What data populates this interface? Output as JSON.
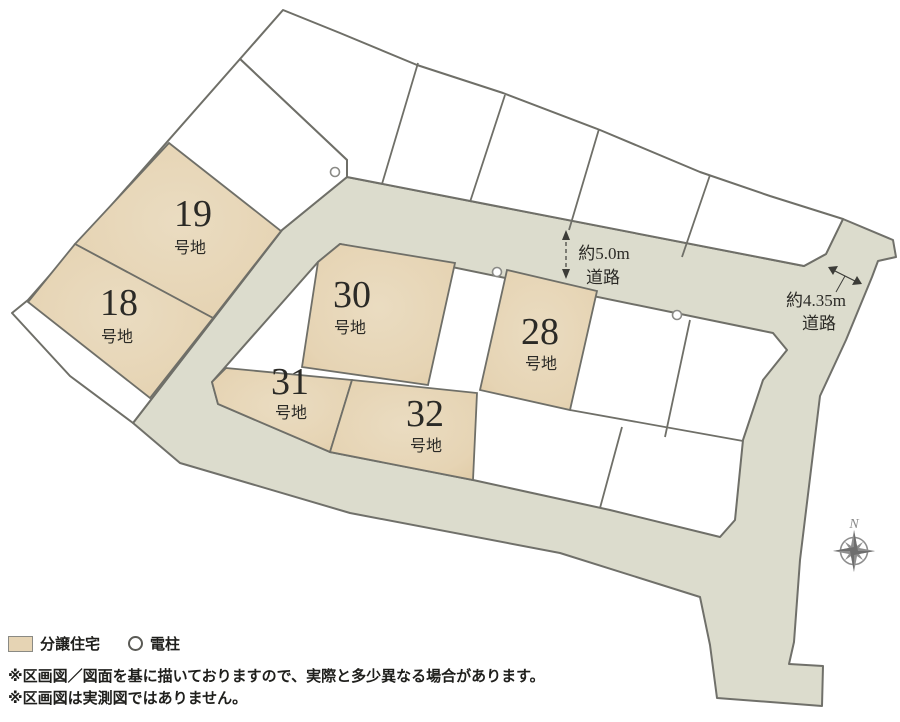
{
  "plots": {
    "items": [
      {
        "id": "19",
        "num": "19",
        "suffix": "号地"
      },
      {
        "id": "18",
        "num": "18",
        "suffix": "号地"
      },
      {
        "id": "30",
        "num": "30",
        "suffix": "号地"
      },
      {
        "id": "31",
        "num": "31",
        "suffix": "号地"
      },
      {
        "id": "32",
        "num": "32",
        "suffix": "号地"
      },
      {
        "id": "28",
        "num": "28",
        "suffix": "号地"
      }
    ]
  },
  "roads": {
    "road_5m": {
      "line1": "約5.0m",
      "line2": "道路"
    },
    "road_435m": {
      "line1": "約4.35m",
      "line2": "道路"
    }
  },
  "compass": {
    "north_label": "N"
  },
  "legend": {
    "items": [
      {
        "label": "分譲住宅"
      },
      {
        "label": "電柱"
      }
    ]
  },
  "notes": {
    "line1": "※区画図／図面を基に描いておりますので、実際と多少異なる場合があります。",
    "line2": "※区画図は実測図ではありません。"
  },
  "colors": {
    "lot_fill": "#e6d4b4",
    "road_fill": "#dcdccd",
    "outline": "#6f6f68",
    "text": "#2b2a26"
  }
}
